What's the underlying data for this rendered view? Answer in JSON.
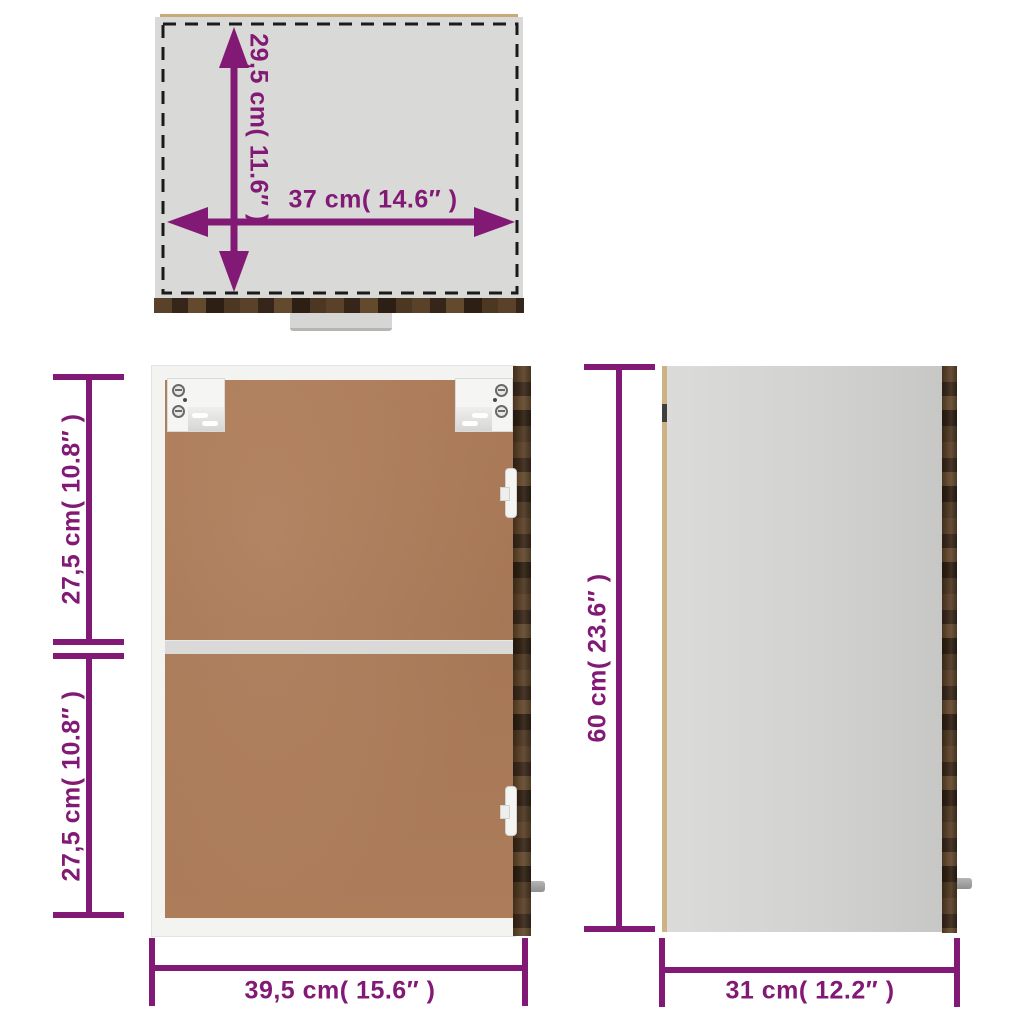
{
  "diagram": {
    "accent_color": "#821a75",
    "dash_color": "#1a1a1a",
    "top_view": {
      "depth_label": "29,5 cm( 11.6″ )",
      "width_label": "37 cm( 14.6″ )"
    },
    "front_view": {
      "upper_compartment_label": "27,5 cm( 10.8″ )",
      "lower_compartment_label": "27,5 cm( 10.8″ )",
      "width_label": "39,5 cm( 15.6″ )"
    },
    "side_view": {
      "height_label": "60 cm( 23.6″ )",
      "depth_label": "31 cm( 12.2″ )"
    }
  }
}
